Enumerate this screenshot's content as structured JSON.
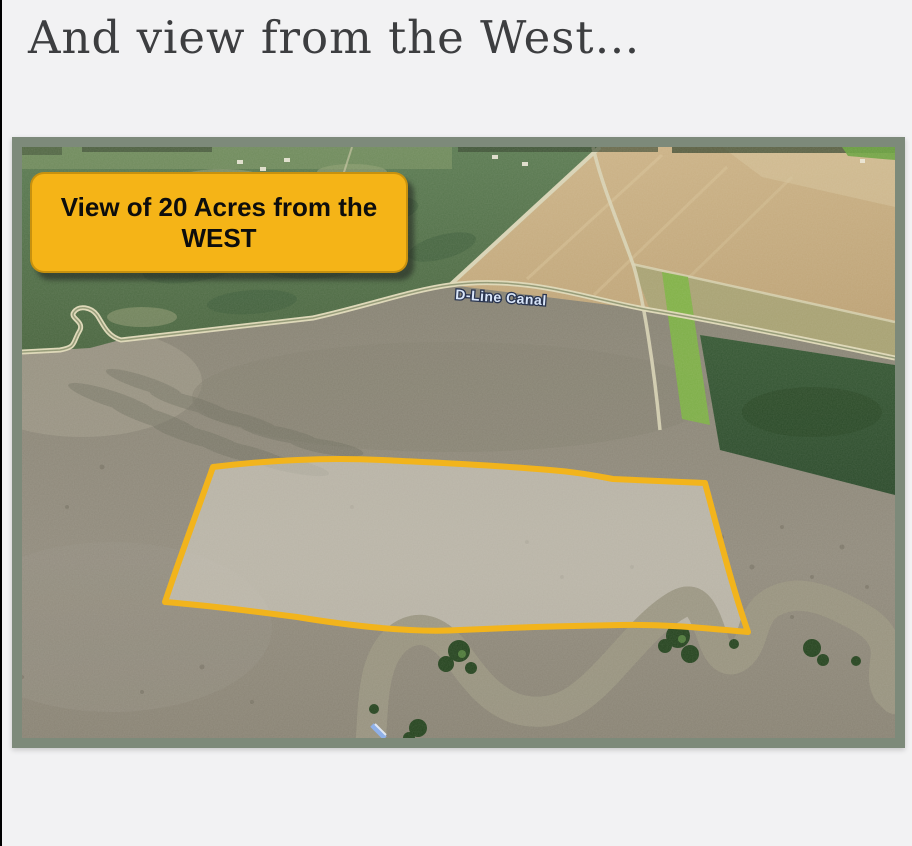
{
  "page": {
    "title": "And view from the West…"
  },
  "aerial_view": {
    "callout": {
      "line1": "View of 20 Acres from the",
      "line2": "WEST"
    },
    "canal_label": "D-Line Canal",
    "colors": {
      "callout_fill": "#F5B417",
      "boundary_outline": "#F2B41C",
      "photo_frame": "#7D8A7A",
      "canal_label_text": "#D9E6FA",
      "page_background": "#F2F2F3"
    }
  }
}
